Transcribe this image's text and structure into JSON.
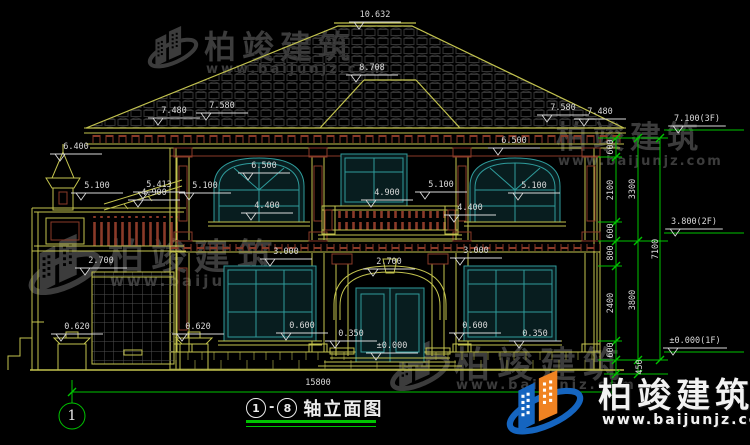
{
  "drawing": {
    "title": "轴立面图",
    "axis_from": "1",
    "axis_to": "8",
    "axis_bubble": "1",
    "title_dash": "-",
    "overall_width_dim": "15800"
  },
  "watermarks": {
    "brand": "柏竣建筑",
    "url": "www.baijunjz.com"
  },
  "colors": {
    "background": "#000000",
    "line_yellow": "#c3c34e",
    "line_maroon": "#8a3a28",
    "window_cyan": "#2f9b9b",
    "dimension_green": "#00c400",
    "text_white": "#d9d9d9",
    "watermark_gray": "#3c3c3c",
    "logo_blue": "#1565c0",
    "logo_orange": "#f08322"
  },
  "labels": [
    {
      "t": "10.632",
      "x": 375,
      "y": 15,
      "f": 1
    },
    {
      "t": "8.708",
      "x": 372,
      "y": 68,
      "f": 1
    },
    {
      "t": "7.480",
      "x": 174,
      "y": 111,
      "f": 1
    },
    {
      "t": "7.580",
      "x": 222,
      "y": 106,
      "f": 1
    },
    {
      "t": "7.580",
      "x": 563,
      "y": 108,
      "f": 1
    },
    {
      "t": "7.480",
      "x": 600,
      "y": 112,
      "f": 1
    },
    {
      "t": "7.100(3F)",
      "x": 697,
      "y": 119,
      "f": 1
    },
    {
      "t": "6.400",
      "x": 76,
      "y": 147,
      "f": 1
    },
    {
      "t": "6.500",
      "x": 264,
      "y": 166,
      "f": 1
    },
    {
      "t": "6.500",
      "x": 514,
      "y": 141,
      "f": 1
    },
    {
      "t": "5.413",
      "x": 159,
      "y": 185,
      "f": 1
    },
    {
      "t": "5.100",
      "x": 97,
      "y": 186,
      "f": 1
    },
    {
      "t": "5.100",
      "x": 205,
      "y": 186,
      "f": 1
    },
    {
      "t": "4.900",
      "x": 154,
      "y": 193,
      "f": 1
    },
    {
      "t": "4.900",
      "x": 387,
      "y": 193,
      "f": 1
    },
    {
      "t": "5.100",
      "x": 441,
      "y": 185,
      "f": 1
    },
    {
      "t": "5.100",
      "x": 534,
      "y": 186,
      "f": 1
    },
    {
      "t": "4.400",
      "x": 267,
      "y": 206,
      "f": 1
    },
    {
      "t": "4.400",
      "x": 470,
      "y": 208,
      "f": 1
    },
    {
      "t": "3.800(2F)",
      "x": 694,
      "y": 222,
      "f": 1
    },
    {
      "t": "3.000",
      "x": 286,
      "y": 252,
      "f": 1
    },
    {
      "t": "3.000",
      "x": 476,
      "y": 251,
      "f": 1
    },
    {
      "t": "2.700",
      "x": 101,
      "y": 261,
      "f": 1
    },
    {
      "t": "2.700",
      "x": 389,
      "y": 262,
      "f": 1
    },
    {
      "t": "0.620",
      "x": 77,
      "y": 327,
      "f": 1
    },
    {
      "t": "0.620",
      "x": 198,
      "y": 327,
      "f": 1
    },
    {
      "t": "0.600",
      "x": 302,
      "y": 326,
      "f": 1
    },
    {
      "t": "0.600",
      "x": 475,
      "y": 326,
      "f": 1
    },
    {
      "t": "0.350",
      "x": 351,
      "y": 334,
      "f": 1
    },
    {
      "t": "0.350",
      "x": 535,
      "y": 334,
      "f": 1
    },
    {
      "t": "±0.000",
      "x": 392,
      "y": 346,
      "f": 1
    },
    {
      "t": "±0.000(1F)",
      "x": 695,
      "y": 341,
      "f": 1
    },
    {
      "t": "15800",
      "x": 318,
      "y": 383
    },
    {
      "t": "600",
      "x": 611,
      "y": 147,
      "r": 1
    },
    {
      "t": "2100",
      "x": 611,
      "y": 190,
      "r": 1
    },
    {
      "t": "600",
      "x": 611,
      "y": 231,
      "r": 1
    },
    {
      "t": "800",
      "x": 611,
      "y": 253,
      "r": 1
    },
    {
      "t": "2400",
      "x": 611,
      "y": 303,
      "r": 1
    },
    {
      "t": "600",
      "x": 611,
      "y": 350,
      "r": 1
    },
    {
      "t": "3300",
      "x": 633,
      "y": 189,
      "r": 1
    },
    {
      "t": "3800",
      "x": 633,
      "y": 300,
      "r": 1
    },
    {
      "t": "450",
      "x": 640,
      "y": 367,
      "r": 1
    },
    {
      "t": "7100",
      "x": 656,
      "y": 249,
      "r": 1
    }
  ]
}
